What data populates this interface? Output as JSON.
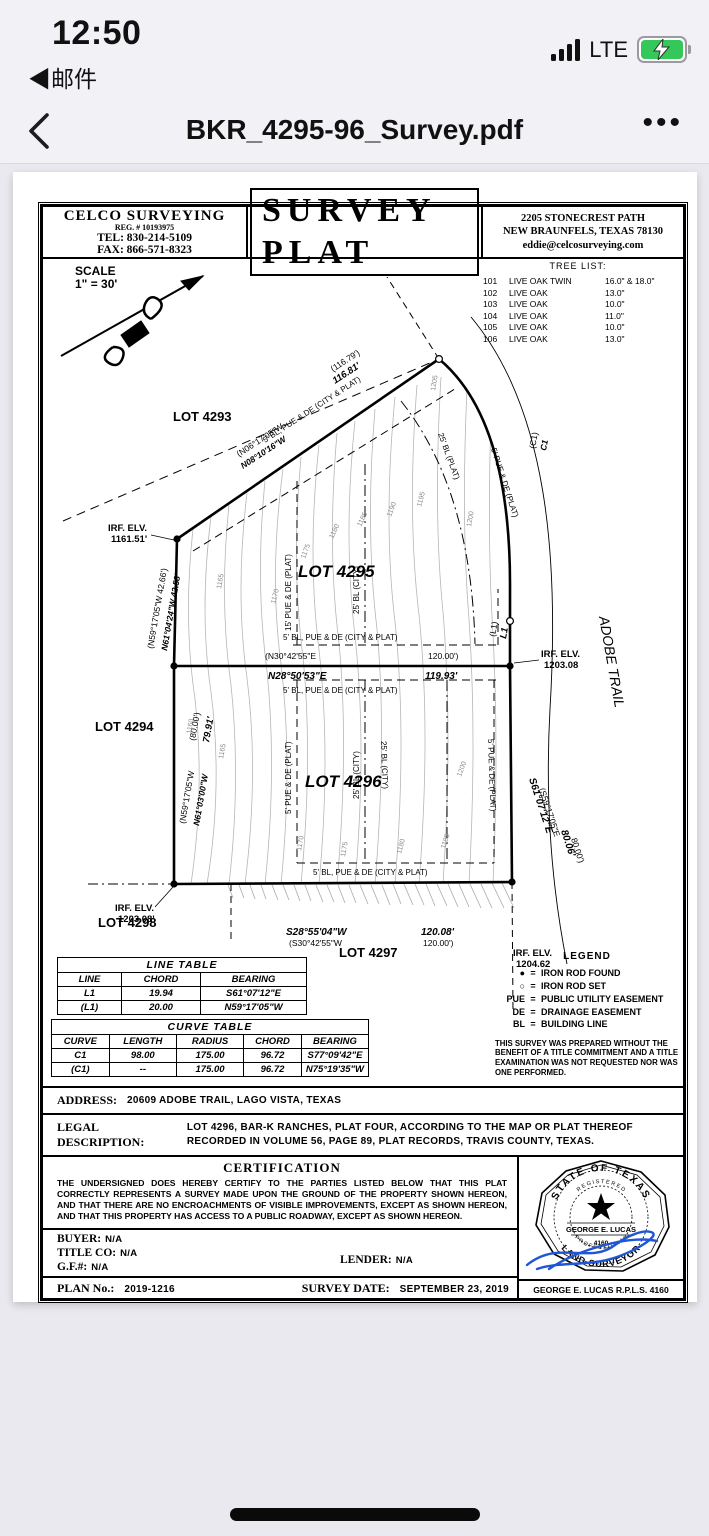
{
  "status_bar": {
    "time": "12:50",
    "back_app": "◀邮件",
    "network": "LTE"
  },
  "nav": {
    "title": "BKR_4295-96_Survey.pdf",
    "more": "•••"
  },
  "doc": {
    "header": {
      "company": "CELCO  SURVEYING",
      "reg": "REG. # 10193975",
      "tel": "TEL: 830-214-5109",
      "fax": "FAX: 866-571-8323",
      "title": "SURVEY  PLAT",
      "address1": "2205  STONECREST  PATH",
      "address2": "NEW  BRAUNFELS,  TEXAS   78130",
      "email": "eddie@celcosurveying.com"
    },
    "scale": {
      "line1": "SCALE",
      "line2": "1\" = 30'"
    },
    "tree_list": {
      "title": "TREE  LIST:",
      "rows": [
        {
          "id": "101",
          "species": "LIVE OAK TWIN",
          "size": "16.0\" & 18.0\""
        },
        {
          "id": "102",
          "species": "LIVE OAK",
          "size": "13.0\""
        },
        {
          "id": "103",
          "species": "LIVE OAK",
          "size": "10.0\""
        },
        {
          "id": "104",
          "species": "LIVE OAK",
          "size": "11.0\""
        },
        {
          "id": "105",
          "species": "LIVE OAK",
          "size": "10.0\""
        },
        {
          "id": "106",
          "species": "LIVE OAK",
          "size": "13.0\""
        }
      ]
    },
    "plat": {
      "lots": {
        "l4293": "LOT 4293",
        "l4294": "LOT 4294",
        "l4295": "LOT 4295",
        "l4296": "LOT 4296",
        "l4297": "LOT 4297",
        "l4298": "LOT 4298"
      },
      "street": "ADOBE  TRAIL",
      "dims": {
        "top_bearing_plat": "(N06°17'05\"W",
        "top_bearing": "N08°10'16\"W",
        "top_dist_plat": "(116.79')",
        "top_dist": "116.81'",
        "left4295_plat": "(N59°17'05\"W   42.66')",
        "left4295": "N61°04'24\"W   42.58'",
        "mid_plat": "(N30°42'55\"E",
        "mid_dist_plat": "120.00')",
        "mid_bearing": "N28°50'53\"E",
        "mid_dist": "119.93'",
        "left4296_plat": "(N59°17'05\"W",
        "left4296": "N61°03'00\"W",
        "left4296_dist_plat": "(80.00')",
        "left4296_dist": "79.91'",
        "bot_bearing": "S28°55'04\"W",
        "bot_bearing_plat": "(S30°42'55\"W",
        "bot_dist": "120.08'",
        "bot_dist_plat": "120.00')",
        "right_plat": "(S59°17'05\"E",
        "right_bearing": "S61°07'12\"E",
        "right_dist_plat": "80.00')",
        "right_dist": "80.06'",
        "c1": "C1",
        "c1_plat": "(C1)",
        "l1": "L1",
        "l1_plat": "(L1)"
      },
      "irf": {
        "label": "IRF.  ELV.",
        "tl": "1161.51'",
        "mr": "1203.08",
        "bl": "1203.08'",
        "br": "1204.62"
      },
      "easements": {
        "bl_pue_de": "5' BL, PUE & DE (CITY & PLAT)",
        "bl25_plat": "25' BL (PLAT)",
        "pue5_plat": "5' PUE & DE (PLAT)",
        "pue15_plat": "15' PUE & DE (PLAT)",
        "bl25_city": "25' BL (CITY)"
      },
      "contour_labels": [
        "1160",
        "1165",
        "1170",
        "1175",
        "1180",
        "1185",
        "1190",
        "1195",
        "1200",
        "1205"
      ]
    },
    "line_table": {
      "title": "LINE  TABLE",
      "headers": [
        "LINE",
        "CHORD",
        "BEARING"
      ],
      "rows": [
        [
          "L1",
          "19.94",
          "S61°07'12\"E"
        ],
        [
          "(L1)",
          "20.00",
          "N59°17'05\"W"
        ]
      ]
    },
    "curve_table": {
      "title": "CURVE  TABLE",
      "headers": [
        "CURVE",
        "LENGTH",
        "RADIUS",
        "CHORD",
        "BEARING"
      ],
      "rows": [
        [
          "C1",
          "98.00",
          "175.00",
          "96.72",
          "S77°09'42\"E"
        ],
        [
          "(C1)",
          "--",
          "175.00",
          "96.72",
          "N75°19'35\"W"
        ]
      ]
    },
    "legend": {
      "title": "LEGEND",
      "eq": "=",
      "items": [
        {
          "sym": "●",
          "name": "IRON ROD FOUND"
        },
        {
          "sym": "○",
          "name": "IRON ROD SET"
        },
        {
          "sym": "PUE",
          "name": "PUBLIC UTILITY EASEMENT"
        },
        {
          "sym": "DE",
          "name": "DRAINAGE EASEMENT"
        },
        {
          "sym": "BL",
          "name": "BUILDING LINE"
        }
      ],
      "note": "THIS SURVEY WAS PREPARED WITHOUT THE BENEFIT OF A TITLE COMMITMENT AND A TITLE EXAMINATION WAS NOT REQUESTED NOR WAS ONE PERFORMED."
    },
    "address": {
      "label": "ADDRESS:",
      "value": "20609 ADOBE TRAIL, LAGO VISTA, TEXAS"
    },
    "legal": {
      "label": "LEGAL DESCRIPTION:",
      "value": "LOT 4296, BAR-K RANCHES, PLAT FOUR, ACCORDING TO THE MAP OR PLAT THEREOF RECORDED IN VOLUME 56, PAGE 89, PLAT RECORDS, TRAVIS COUNTY, TEXAS."
    },
    "certification": {
      "title": "CERTIFICATION",
      "body": "THE UNDERSIGNED DOES HEREBY CERTIFY TO THE PARTIES LISTED BELOW THAT THIS PLAT CORRECTLY REPRESENTS A SURVEY MADE UPON THE GROUND OF THE PROPERTY SHOWN HEREON, AND THAT THERE ARE NO ENCROACHMENTS OF VISIBLE IMPROVEMENTS, EXCEPT AS SHOWN HEREON, AND THAT THIS PROPERTY HAS ACCESS TO A PUBLIC ROADWAY, EXCEPT AS SHOWN HEREON."
    },
    "parties": {
      "buyer_label": "BUYER:",
      "buyer_value": "N/A",
      "title_label": "TITLE  CO:",
      "title_value": "N/A",
      "gf_label": "G.F.#:",
      "gf_value": "N/A",
      "lender_label": "LENDER:",
      "lender_value": "N/A"
    },
    "footer": {
      "plan_label": "PLAN  No.:",
      "plan_value": "2019-1216",
      "date_label": "SURVEY  DATE:",
      "date_value": "SEPTEMBER 23, 2019",
      "surveyor": "GEORGE  E.  LUCAS     R.P.L.S.  4160"
    },
    "seal": {
      "state": "STATE OF TEXAS",
      "registered": "R E G I S T E R E D",
      "name": "GEORGE E. LUCAS",
      "number": "4160",
      "professional": "P R O F E S S I O N A L",
      "land_surveyor": "LAND SURVEYOR"
    }
  }
}
